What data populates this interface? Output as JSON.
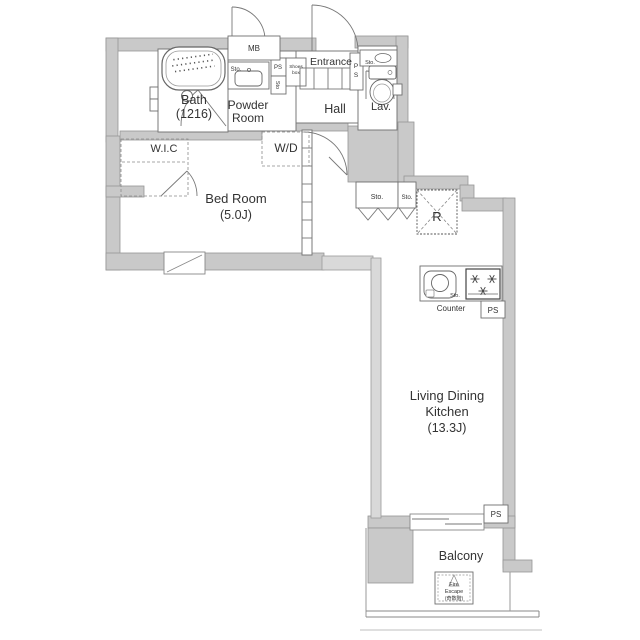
{
  "plan": {
    "rooms": {
      "bath": {
        "name": "Bath",
        "size": "(1216)"
      },
      "powder": {
        "line1": "Powder",
        "line2": "Room"
      },
      "entrance": "Entrance",
      "hall": "Hall",
      "lavatory": "Lav.",
      "wic": "W.I.C",
      "bedroom": {
        "name": "Bed Room",
        "size": "(5.0J)"
      },
      "ldk": {
        "line1": "Living Dining",
        "line2": "Kitchen",
        "size": "(13.3J)"
      },
      "balcony": "Balcony"
    },
    "fixtures": {
      "mb": "MB",
      "wd": "W/D",
      "refrigerator": "R",
      "counter": "Counter",
      "ps": "PS",
      "ps_p": "P",
      "ps_s": "S",
      "sto": "Sto.",
      "sto_short": "Sto",
      "shoes_line1": "Shoes",
      "shoes_line2": "box",
      "fire_escape": {
        "line1": "Fire",
        "line2": "Escape",
        "line3": "(奇数階)"
      }
    },
    "colors": {
      "wall_fill": "#c9c9c9",
      "wall_stroke": "#969696",
      "line": "#787878",
      "text": "#333333",
      "background": "#ffffff"
    }
  }
}
